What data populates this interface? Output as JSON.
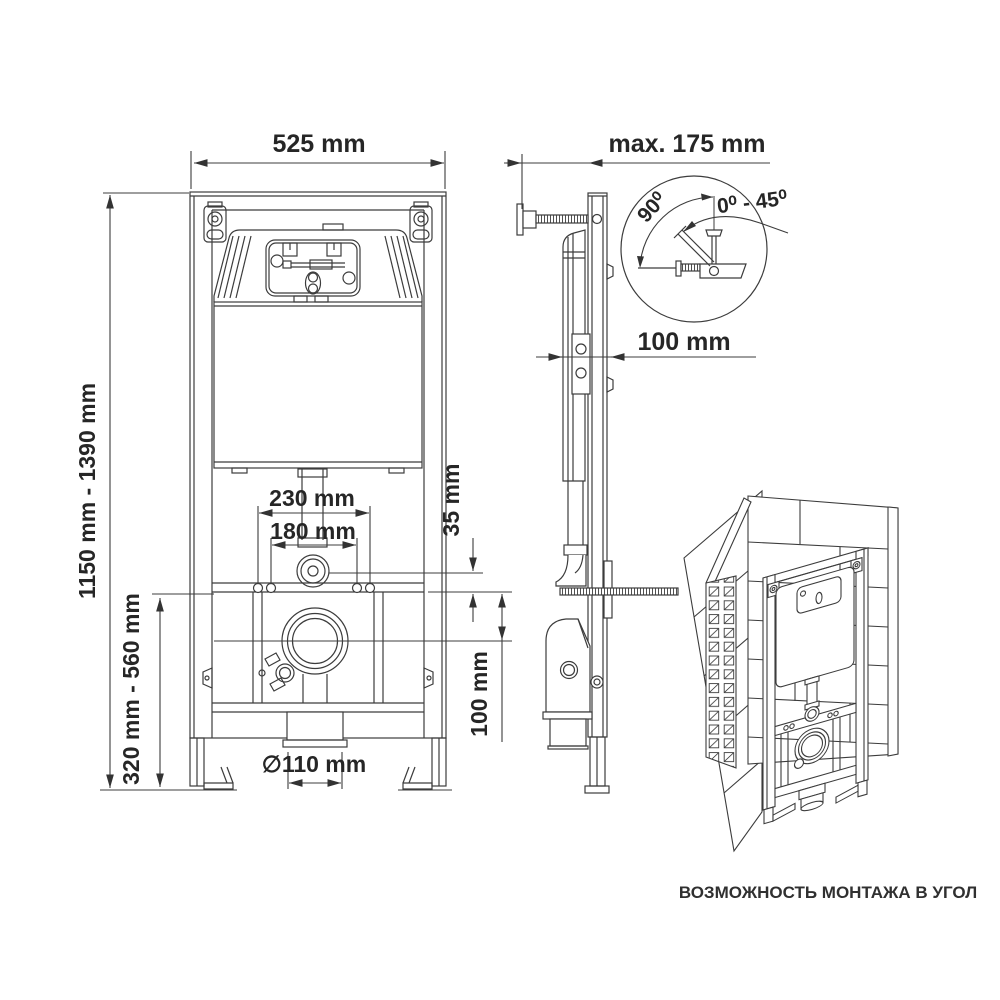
{
  "drawing": {
    "front_view": {
      "width": "525 mm",
      "height_range": "1150 mm - 1390 mm",
      "bowl_height_range": "320 mm - 560 mm",
      "flush_pipe_spacing": "230 mm",
      "fixing_bolt_spacing": "180 mm",
      "flush_elbow_offset": "35 mm",
      "outlet_drop": "100 mm",
      "outlet_diameter": "∅110 mm"
    },
    "side_view": {
      "max_wall_distance": "max. 175 mm",
      "frame_depth": "100 mm"
    },
    "detail_circle": {
      "bracket_angle": "90⁰",
      "adjustment_range": "0⁰ - 45⁰"
    },
    "corner_view": {
      "caption": "ВОЗМОЖНОСТЬ МОНТАЖА В УГОЛ"
    },
    "colors": {
      "line": "#3c3c3c",
      "text": "#262626",
      "background": "#ffffff"
    }
  }
}
